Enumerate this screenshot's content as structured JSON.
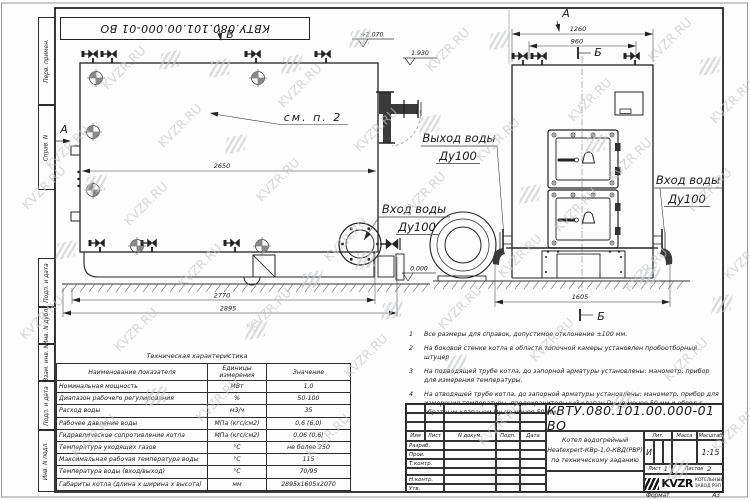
{
  "watermark": {
    "text": "KVZR.RU"
  },
  "frame": {
    "top_stamp": "КВТУ.080.101.00.000-01 ВО",
    "left_strip": [
      "Перв. примен.",
      "Справ. N",
      "Подп. и дата",
      "Инв. N дубл.",
      "Взам. инв. N",
      "Подп. и дата",
      "Инв. N подл."
    ]
  },
  "drawing": {
    "side_view": {
      "view_b": "В",
      "view_a": "А",
      "callout": "см. п. 2",
      "dim_inner": "2650",
      "dim_mid": "2770",
      "dim_overall": "2895",
      "elev_top": "+2.070",
      "elev_shell": "1.930",
      "elev_zero": "0.000",
      "outlet_label": "Выход воды",
      "outlet_dn": "Ду100",
      "inlet_label": "Вход воды",
      "inlet_dn": "Ду100"
    },
    "front_view": {
      "view_label": "А",
      "section": "Б",
      "dim_width": "1260",
      "dim_valves": "960",
      "dim_base": "1605",
      "inlet_label": "Вход воды",
      "inlet_dn": "Ду100"
    }
  },
  "notes": {
    "items": [
      {
        "num": "1",
        "text": "Все размеры для справок, допустимое отклонение ±100 мм."
      },
      {
        "num": "2",
        "text": "На боковой стенке котла в области топочной камеры установлен пробоотборный штуцер"
      },
      {
        "num": "3",
        "text": "На  подводящей трубе котла, до запорной арматуры установлены: манометр, прибор для измерения температуры."
      },
      {
        "num": "4",
        "text": "На отводящей трубе котла, до запорной арматуры установлены: манометр, прибор для измерения температуры, предохранительный клапан Dу не менее 50 мм и обвод с обратным клапаном Dу не менее 50 мм."
      }
    ]
  },
  "tech_table": {
    "title": "Техническая характеристика",
    "headers": [
      "Наименование показателя",
      "Единицы измерения",
      "Значение"
    ],
    "rows": [
      [
        "Номинальная мощность",
        "МВт",
        "1,0"
      ],
      [
        "Диапазон рабочего регулирования",
        "%",
        "50-100"
      ],
      [
        "Расход воды",
        "м3/ч",
        "35"
      ],
      [
        "Рабочее давление воды",
        "МПа (кгс/см2)",
        "0,6 (6,0)"
      ],
      [
        "Гидравлическое сопротивление котла",
        "МПа (кгс/см2)",
        "0,06 (0,6)"
      ],
      [
        "Температура уходящих газов",
        "°С",
        "не более 250"
      ],
      [
        "Максимальная рабочая температура воды",
        "°С",
        "115"
      ],
      [
        "Температура воды (вход/выход)",
        "°С",
        "70/95"
      ],
      [
        "Габариты котла (длина х ширина х высота)",
        "мм",
        "2895х1605х2070"
      ]
    ]
  },
  "title_block": {
    "doc_number": "КВТУ.080.101.00.000-01 ВО",
    "header_cols": [
      "Изм",
      "Лист",
      "N докум.",
      "Подп.",
      "Дата"
    ],
    "row_labels": [
      "Разраб.",
      "Пров.",
      "Т.контр.",
      "",
      "Н.контр.",
      "Утв."
    ],
    "product_name_line1": "Котел водогрейный",
    "product_name_line2": "Heatexpert-КВр-1,0-КВД(РВР)",
    "product_name_line3": "по техническому заданию",
    "lit_header": "Лит.",
    "mass_header": "Масса",
    "scale_header": "Масштаб",
    "lit_value": "И",
    "scale_value": "1:15",
    "sheet_label": "Лист",
    "sheet_value": "1",
    "sheets_label": "Листов",
    "sheets_value": "2",
    "logo_text": "KVZR",
    "company_line1": "КОТЕЛЬНЫЙ",
    "company_line2": "ЗАВОД РЭП",
    "format_label": "Формат",
    "format_value": "А3"
  }
}
